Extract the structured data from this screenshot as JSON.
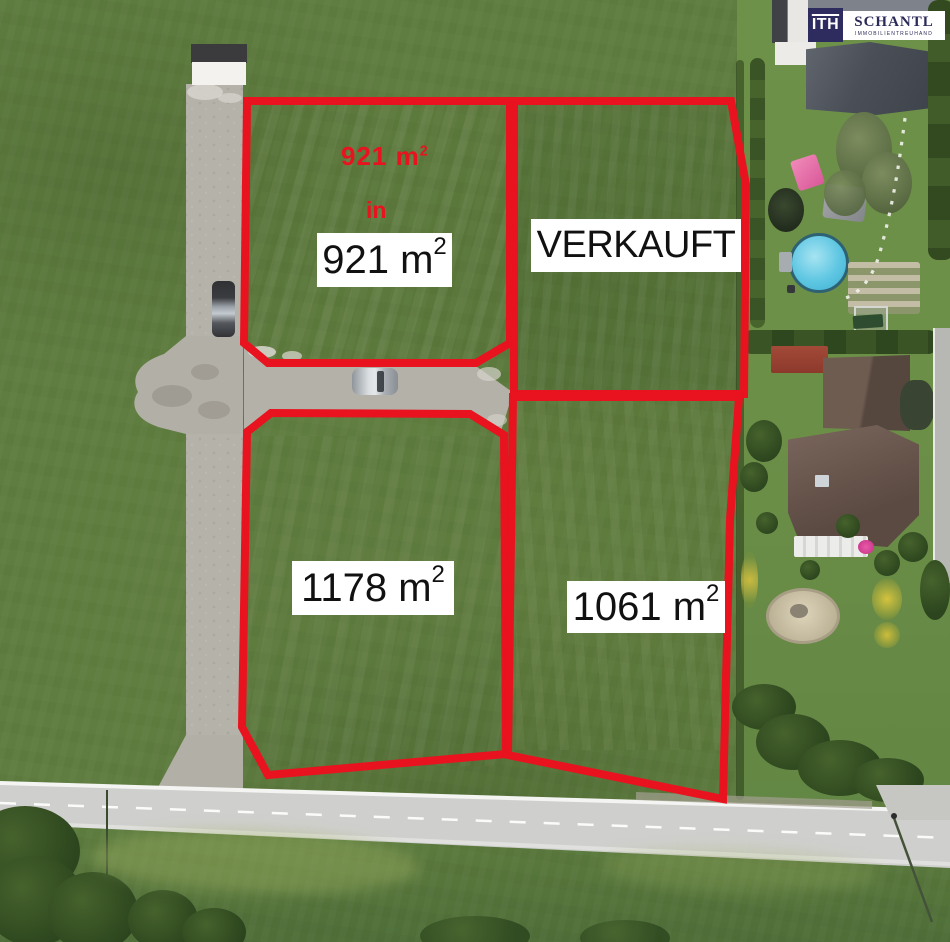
{
  "branding": {
    "monogram": "ITH",
    "company": "SCHANTL",
    "tagline": "IMMOBILIENTREUHAND"
  },
  "watermark": {
    "line1": "921 m",
    "line1_sup": "2",
    "line2": "in"
  },
  "plots": {
    "nw": {
      "label": "921 m",
      "sup": "2",
      "area_m2": 921,
      "status": "available"
    },
    "ne": {
      "label": "VERKAUFT",
      "sup": "",
      "status": "sold"
    },
    "sw": {
      "label": "1178 m",
      "sup": "2",
      "area_m2": 1178,
      "status": "available"
    },
    "se": {
      "label": "1061 m",
      "sup": "2",
      "area_m2": 1061,
      "status": "available"
    }
  },
  "colors": {
    "boundary_red": "#e8131f",
    "logo_navy": "#2e2c5e",
    "pool_blue": "#5ec6e2"
  }
}
